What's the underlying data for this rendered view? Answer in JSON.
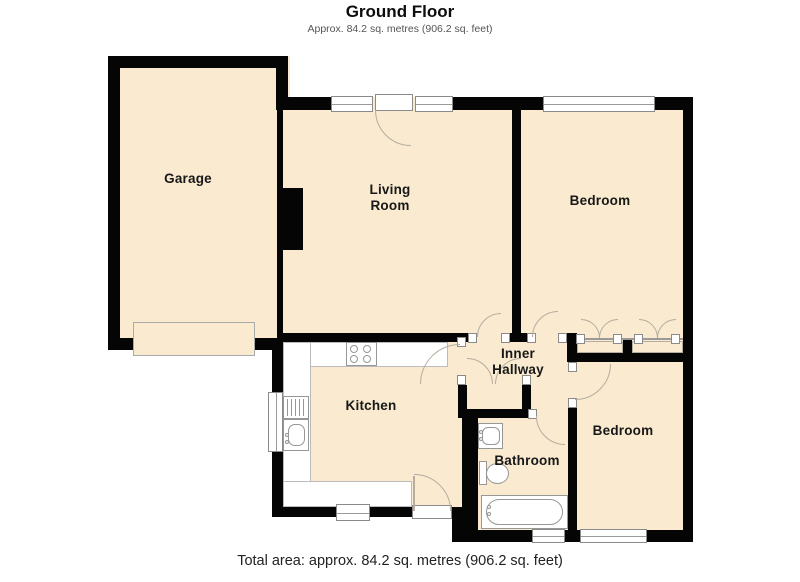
{
  "header": {
    "title": "Ground Floor",
    "subtitle": "Approx. 84.2 sq. metres (906.2 sq. feet)"
  },
  "footer": {
    "total_area": "Total area: approx. 84.2 sq. metres (906.2 sq. feet)"
  },
  "rooms": {
    "garage": {
      "label": "Garage"
    },
    "living_room": {
      "label": "Living\nRoom"
    },
    "bedroom_top": {
      "label": "Bedroom"
    },
    "inner_hallway": {
      "label": "Inner\nHallway"
    },
    "kitchen": {
      "label": "Kitchen"
    },
    "bathroom": {
      "label": "Bathroom"
    },
    "bedroom_bottom": {
      "label": "Bedroom"
    }
  },
  "colors": {
    "room_fill": "#f9ead0",
    "wall": "#050505",
    "door_arc": "#b5ad9f",
    "fixture_outline": "#979797"
  }
}
